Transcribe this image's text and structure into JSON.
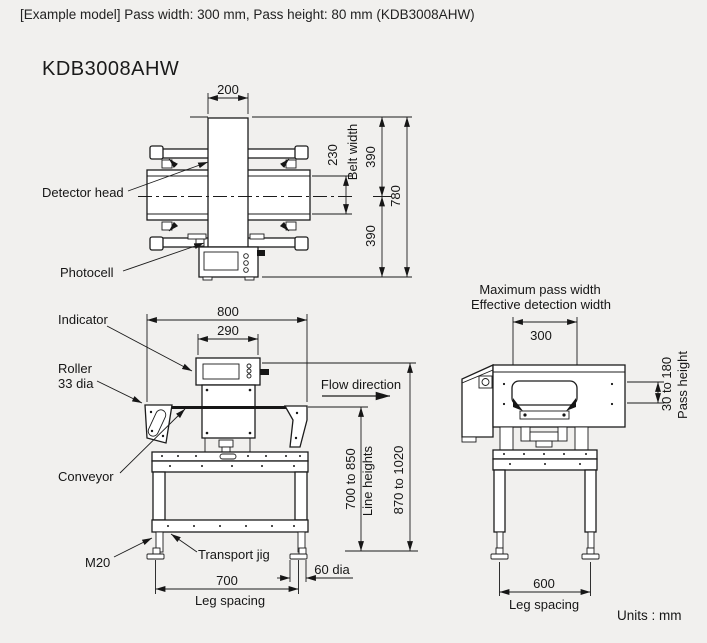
{
  "header": {
    "example_line": "[Example model] Pass width: 300 mm, Pass height: 80 mm (KDB3008AHW)",
    "model": "KDB3008AHW"
  },
  "front_view": {
    "dim_200": "200",
    "dim_230": "230",
    "belt_width_label": "Belt width",
    "dim_390_top": "390",
    "dim_780": "780",
    "dim_390_bottom": "390",
    "label_detector_head": "Detector head",
    "label_photocell": "Photocell"
  },
  "side_view": {
    "dim_800": "800",
    "dim_290": "290",
    "label_indicator": "Indicator",
    "label_roller": "Roller",
    "label_roller_dia": "33 dia",
    "label_conveyor": "Conveyor",
    "flow_direction": "Flow direction",
    "dim_line_heights_value": "700 to 850",
    "dim_line_heights_label": "Line heights",
    "dim_total_height": "870 to 1020",
    "label_m20": "M20",
    "label_transport_jig": "Transport jig",
    "dim_leg_spacing_value": "700",
    "dim_leg_spacing_label": "Leg spacing",
    "dim_foot_dia": "60 dia"
  },
  "end_view": {
    "label_max_pass_width": "Maximum pass width",
    "label_effective_width": "Effective detection width",
    "dim_300": "300",
    "dim_pass_height_value": "30 to 180",
    "dim_pass_height_label": "Pass height",
    "dim_leg_spacing_value": "600",
    "dim_leg_spacing_label": "Leg spacing"
  },
  "footer": {
    "units_label": "Units : mm"
  },
  "colors": {
    "background": "#f1f0ee",
    "line": "#1c1c1c"
  }
}
